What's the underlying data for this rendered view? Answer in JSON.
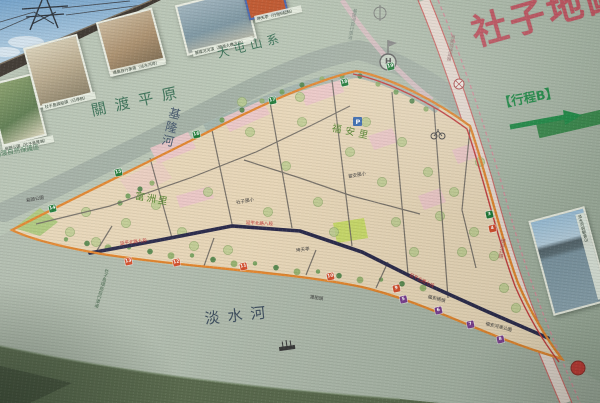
{
  "title": "社子地圖",
  "route_b": {
    "label": "【行程B】"
  },
  "geo": {
    "mountain": "大屯山系",
    "plain": "關渡平原",
    "reserve": "關渡自然保護區",
    "keelung_river": "基隆河",
    "tamsui_river": "淡水河"
  },
  "districts": {
    "fuan": "福安里",
    "fuzhou": "富洲里"
  },
  "roads": {
    "yanping7": "延平北路七段",
    "yanping8": "延平北路八段",
    "yanping9": "延平北路九段",
    "huanhe": "環河北路",
    "zhoumei": "洲美快速道路",
    "bike_south": "社子島環島自行車道",
    "bike_north": "基隆河自行車道"
  },
  "pois": {
    "helipad": "H",
    "parking": "P",
    "ferry": "渡船頭",
    "wharf": "福安碼頭",
    "park_tip": "島頭公園",
    "park_se": "福安河濱公園",
    "school_a": "社子國小",
    "school_b": "富安國小",
    "temple": "坤天亭"
  },
  "photos": [
    {
      "caption": "島頭公園（社子島尾端）"
    },
    {
      "caption": "社子島渡船頭（已停航）"
    },
    {
      "caption": "環島自行車道（淡水河岸）"
    },
    {
      "caption": "基隆河河濱（關渡大橋方向）"
    },
    {
      "caption": "坤天亭（行程B起點）"
    },
    {
      "caption": "淡水河與觀音山"
    }
  ],
  "markers": {
    "green": [
      {
        "n": "14",
        "x": 52,
        "y": 208
      },
      {
        "n": "15",
        "x": 118,
        "y": 172
      },
      {
        "n": "16",
        "x": 196,
        "y": 134
      },
      {
        "n": "17",
        "x": 272,
        "y": 100
      },
      {
        "n": "18",
        "x": 344,
        "y": 82
      },
      {
        "n": "19",
        "x": 390,
        "y": 66
      },
      {
        "n": "3",
        "x": 489,
        "y": 214
      }
    ],
    "red": [
      {
        "n": "13",
        "x": 128,
        "y": 261
      },
      {
        "n": "12",
        "x": 176,
        "y": 262
      },
      {
        "n": "11",
        "x": 243,
        "y": 266
      },
      {
        "n": "10",
        "x": 330,
        "y": 276
      },
      {
        "n": "9",
        "x": 396,
        "y": 288
      },
      {
        "n": "4",
        "x": 492,
        "y": 228
      }
    ],
    "purple": [
      {
        "n": "5",
        "x": 403,
        "y": 299
      },
      {
        "n": "6",
        "x": 438,
        "y": 310
      },
      {
        "n": "7",
        "x": 470,
        "y": 324
      },
      {
        "n": "8",
        "x": 500,
        "y": 339
      }
    ]
  },
  "colors": {
    "title": "#bf5662",
    "route": "#1d8a45",
    "island": "#e7d6b8",
    "orange_road": "#e2862f",
    "navy_road": "#2c2c4c",
    "green_marker": "#1f7a38",
    "red_marker": "#d4502e",
    "purple_marker": "#7a3f8f"
  }
}
